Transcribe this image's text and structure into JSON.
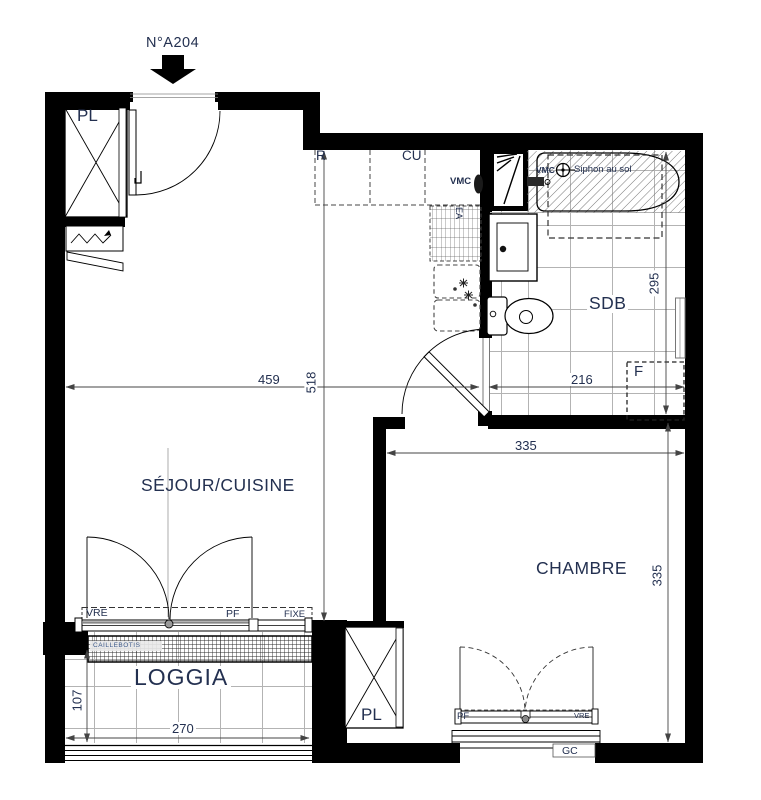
{
  "labels": {
    "unit": "N°A204",
    "room_sejour": "SÉJOUR/CUISINE",
    "room_chambre": "CHAMBRE",
    "room_loggia": "LOGGIA",
    "room_sdb": "SDB",
    "closet_entry": "PL",
    "closet_chambre": "PL",
    "fridge": "R",
    "kitchen_unit": "CU",
    "vmc_kitchen": "VMC",
    "vmc_bath": "VMC",
    "siphon": "Siphon au sol",
    "sink_duct": "EA",
    "window_f": "F",
    "vre_sejour": "VRE",
    "pf_sejour": "PF",
    "fixe_sejour": "FIXE",
    "grating": "CAILLEBOTIS",
    "pf_chambre": "PF",
    "vre_chambre": "VRE",
    "guardrail": "GC"
  },
  "dimensions_cm": {
    "sejour_width": "459",
    "sejour_length": "518",
    "sdb_width": "216",
    "sdb_length": "295",
    "chambre_width": "335",
    "chambre_length": "335",
    "loggia_depth": "107",
    "loggia_width": "270"
  },
  "colors": {
    "wall": "#000000",
    "label_text": "#233050",
    "dimension_line": "#444444",
    "tile_line": "#b3b3b3"
  }
}
